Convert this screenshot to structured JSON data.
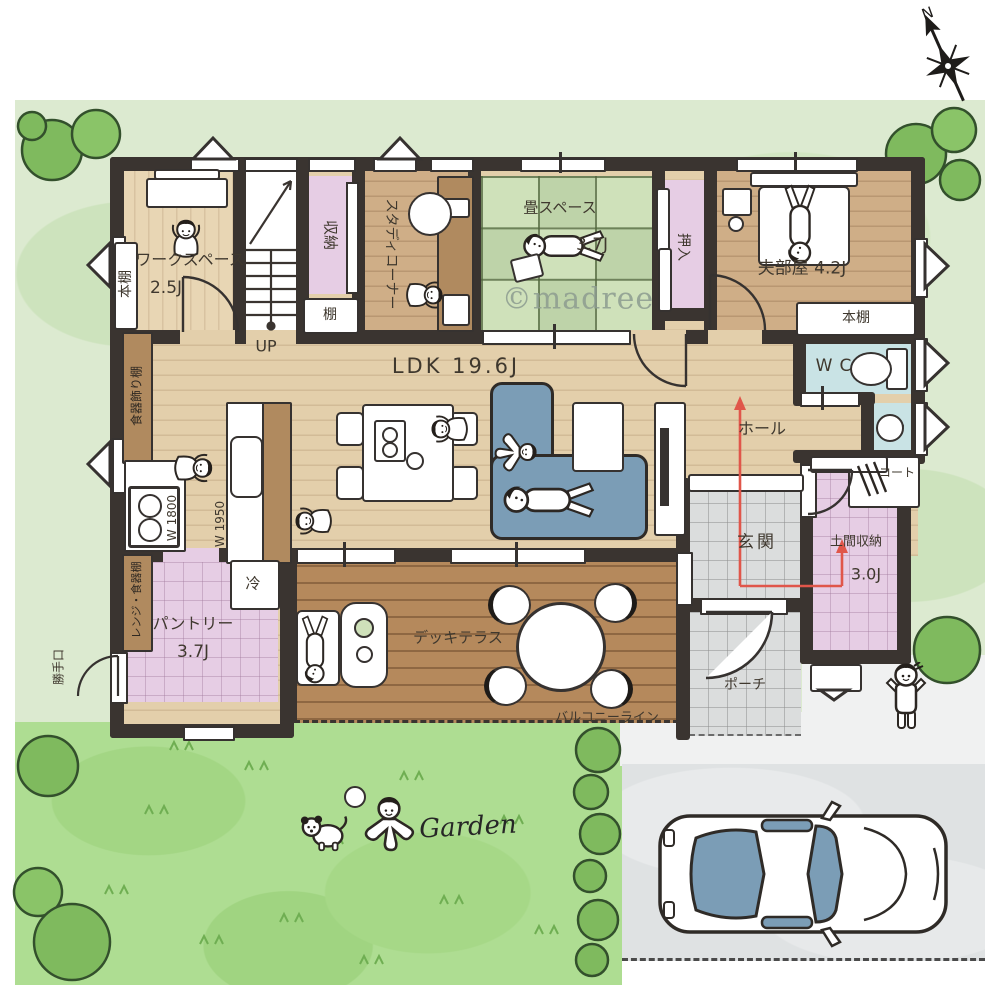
{
  "branding": {
    "watermark": "©madree",
    "compass_north": "N"
  },
  "outdoor": {
    "garden_label": "Garden"
  },
  "rooms": {
    "workspace": {
      "name": "ワークスペース",
      "area": "2.5J"
    },
    "study_corner": {
      "name": "スタディコーナー"
    },
    "tatami": {
      "name": "畳スペース",
      "area": "3.7J"
    },
    "husband_room": {
      "name": "夫部屋",
      "area": "4.2J",
      "display": "夫部屋 4.2J"
    },
    "ldk": {
      "name": "LDK",
      "area": "19.6J",
      "display": "LDK 19.6J"
    },
    "wc": {
      "name": "WC"
    },
    "hall": {
      "name": "ホール"
    },
    "genkan": {
      "name": "玄関"
    },
    "doma": {
      "name": "土間収納",
      "area": "3.0J"
    },
    "pantry": {
      "name": "パントリー",
      "area": "3.7J"
    },
    "deck": {
      "name": "デッキテラス"
    },
    "porch": {
      "name": "ポーチ"
    }
  },
  "fixtures": {
    "bookshelf_left": "本棚",
    "bedroom_bookshelf": "本棚",
    "closet": "収納",
    "shelf": "棚",
    "oshiire": "押入",
    "coat_rack": "コート",
    "fridge": "冷",
    "cupboard_display": "食器飾り棚",
    "range_cupboard": "レンジ・食器棚",
    "counter_w1800": "W 1800",
    "counter_w1950": "W 1950"
  },
  "circulation": {
    "stairs_up": "UP",
    "back_door": "勝手口",
    "balcony_line": "バルコニーライン"
  },
  "colors": {
    "wall": "#3a3430",
    "wood_floor": "#e3cfab",
    "wood_dark": "#cfae87",
    "deck": "#b5895c",
    "tatami_green": "#cfe1ba",
    "accent_pink": "#e6cde4",
    "room_blue": "#c9e3e5",
    "sofa_blue": "#7b9db6",
    "lawn": "#dcead0",
    "garden_green": "#aedd92",
    "tile_gray": "#dbdddd",
    "flow_arrow_red": "#e0564a",
    "tree_green": "#7fba5e"
  }
}
